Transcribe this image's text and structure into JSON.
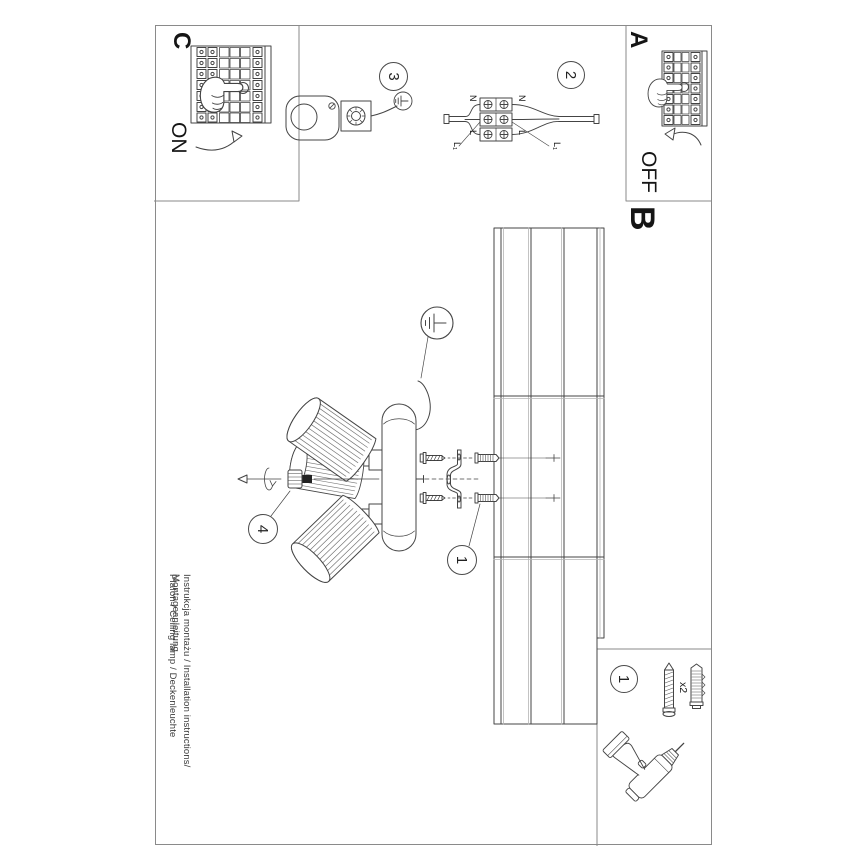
{
  "document": {
    "type": "installation-instruction-sheet",
    "orientation": "rotated-90-clockwise",
    "footer": {
      "line1": "Instrukcja montażu / Installation instructions/ Montageanleitung",
      "line2": "Plafon / Ceiling lamp / Deckenleuchte"
    },
    "sections": {
      "a": {
        "label": "A",
        "action": "OFF"
      },
      "b": {
        "label": "B"
      },
      "c": {
        "label": "C",
        "action": "ON"
      }
    },
    "steps": {
      "step1": "1",
      "step2": "2",
      "step3": "3",
      "step4": "4",
      "parts_step": "1"
    },
    "parts": {
      "quantity": "x2"
    },
    "terminal_labels": {
      "n_top": "N",
      "l_top": "L",
      "l1_top": "L₁",
      "n_bottom": "N",
      "l_bottom": "L",
      "l1_bottom": "L₁"
    },
    "colors": {
      "ink": "#444444",
      "light_line": "#aaaaaa",
      "border": "#8a8a8a",
      "text": "#151515",
      "paper": "#ffffff"
    }
  }
}
